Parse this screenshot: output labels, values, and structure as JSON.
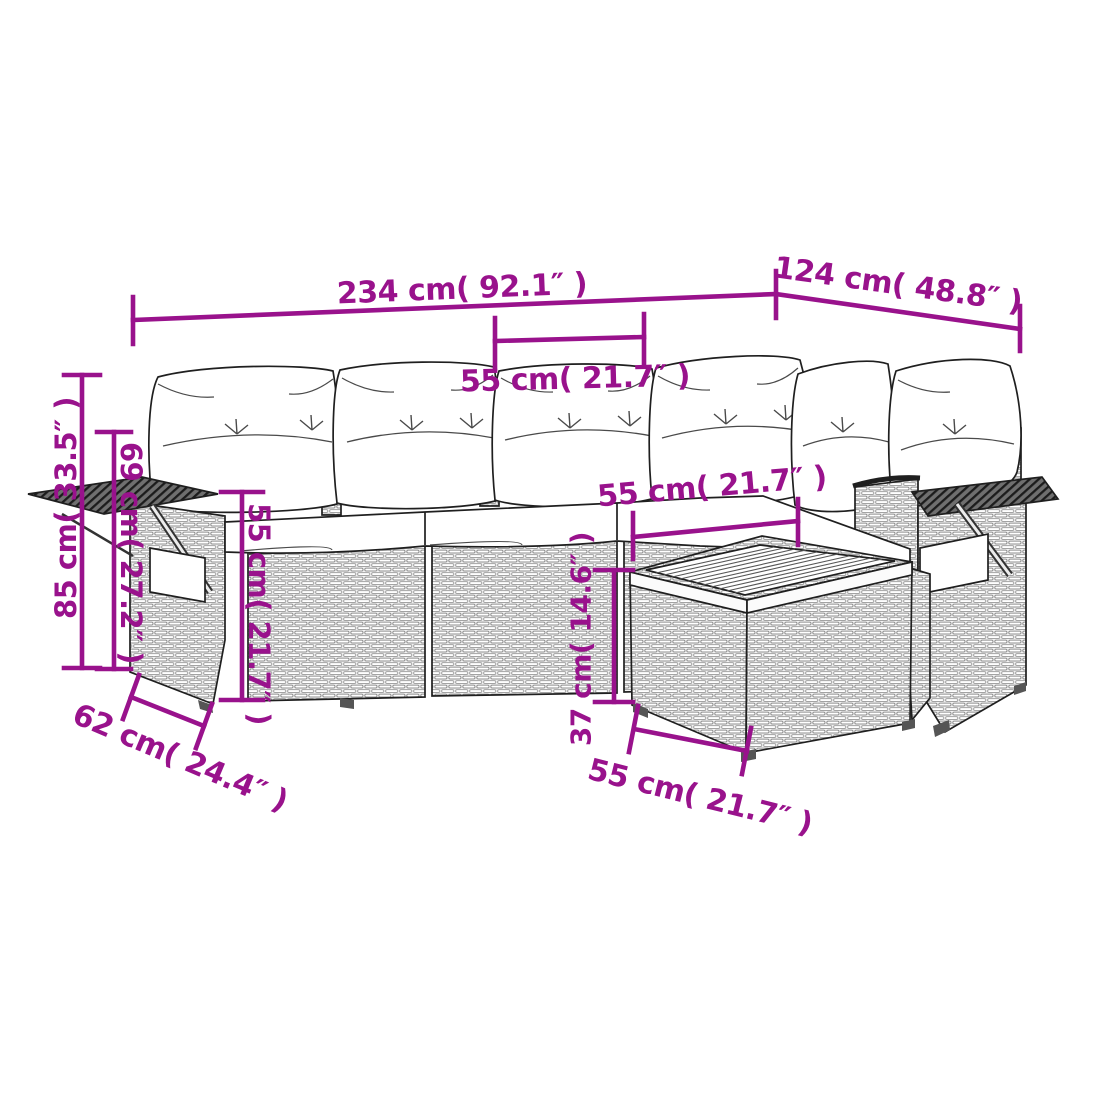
{
  "figure": {
    "kind": "product-dimension-diagram",
    "subject": "gray poly-rattan L-shaped garden sofa set with back cushions, seat pads, fold-out armrest trays and square coffee table"
  },
  "colors": {
    "dimension_annotation": "#99128C",
    "line_art_outline": "#1f1f1f",
    "cushion_fill": "#ffffff",
    "rattan_strand": "#9a9a9a",
    "tray_hatch_dark": "#2a2a2a",
    "background": "#ffffff"
  },
  "dims": {
    "total_width": {
      "text": "234 cm( 92.1″ )",
      "cm": 234,
      "in": 92.1
    },
    "total_depth": {
      "text": "124 cm( 48.8″ )",
      "cm": 124,
      "in": 48.8
    },
    "cushion_width": {
      "text": "55 cm( 21.7″ )",
      "cm": 55,
      "in": 21.7
    },
    "corner_seat_width": {
      "text": "55 cm( 21.7″ )",
      "cm": 55,
      "in": 21.7
    },
    "armrest_height": {
      "text": "55 cm( 21.7″ )",
      "cm": 55,
      "in": 21.7
    },
    "back_height": {
      "text": "69 cm( 27.2″ )",
      "cm": 69,
      "in": 27.2
    },
    "total_height": {
      "text": "85 cm( 33.5″ )",
      "cm": 85,
      "in": 33.5
    },
    "table_height": {
      "text": "37 cm( 14.6″ )",
      "cm": 37,
      "in": 14.6
    },
    "table_width": {
      "text": "55 cm( 21.7″ )",
      "cm": 55,
      "in": 21.7
    },
    "armrest_depth": {
      "text": "62 cm( 24.4″ )",
      "cm": 62,
      "in": 24.4
    }
  }
}
